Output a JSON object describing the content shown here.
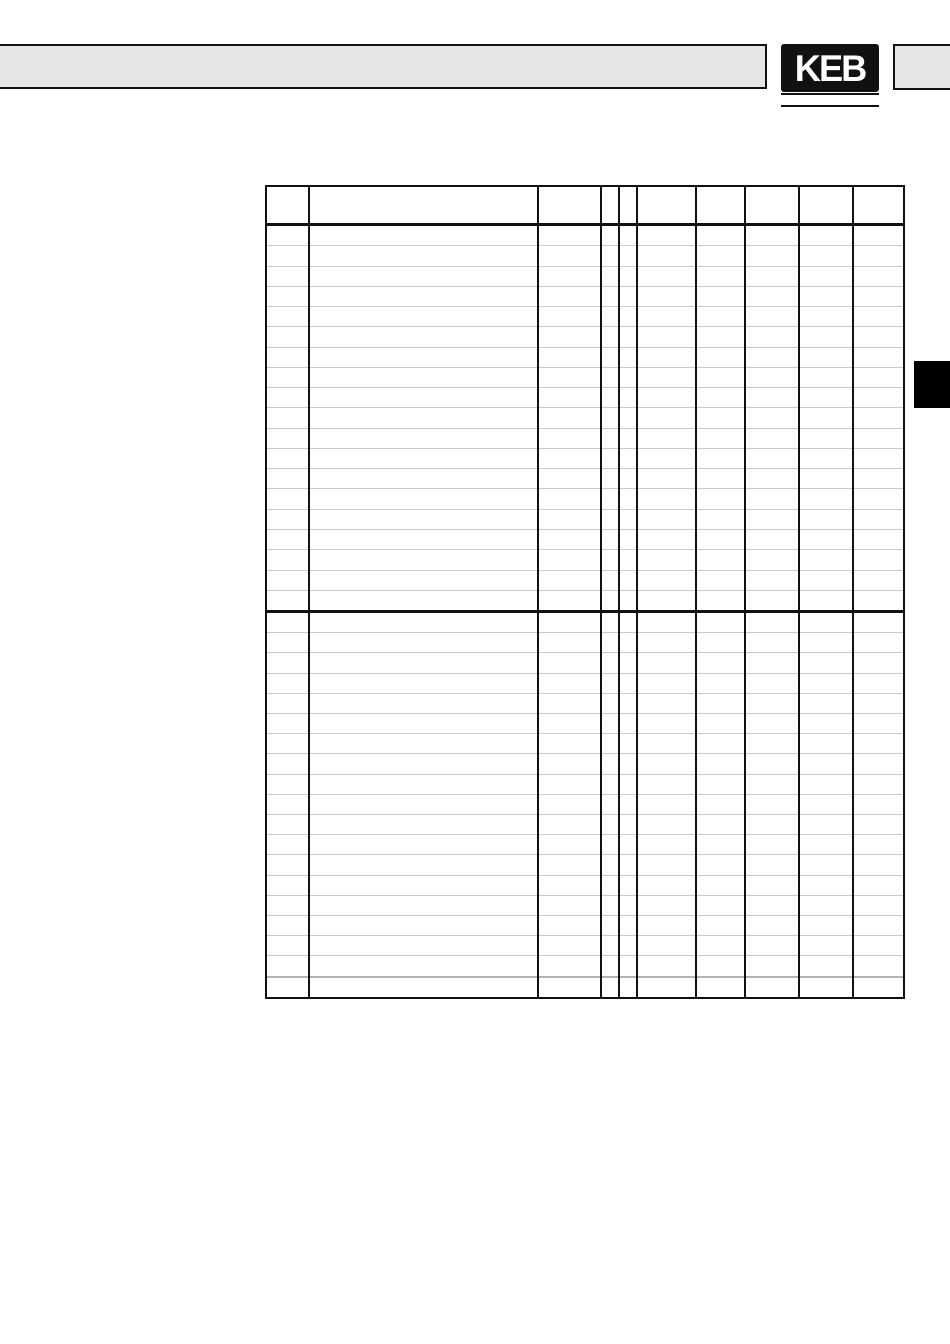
{
  "brand": {
    "logo_text": "KEB"
  },
  "colors": {
    "page_bg": "#ffffff",
    "band_fill": "#e6e6e6",
    "line_ink": "#111111",
    "row_line": "#c9c9c9",
    "row_line_thick": "#b3b3b3",
    "side_tab": "#000000"
  },
  "table": {
    "type": "table",
    "description": "empty parameter grid, no visible text",
    "column_widths": [
      42,
      229,
      63,
      18,
      18,
      59,
      49,
      54,
      54,
      54
    ],
    "header_height": 36,
    "sections": [
      {
        "rows": 19
      },
      {
        "rows": 19,
        "thick_separator_after_row": 18
      }
    ]
  }
}
